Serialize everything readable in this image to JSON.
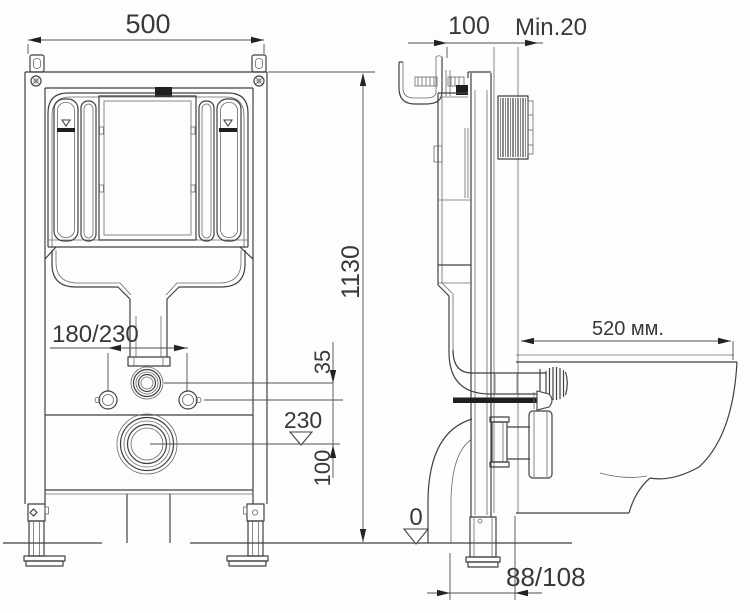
{
  "drawing": {
    "type": "installation-diagram",
    "colors": {
      "ink": "#414141",
      "dim_line": "#4f4f4f",
      "text": "#383838",
      "background": "#fdfdfd"
    },
    "labels": {
      "front": {
        "width": "500",
        "height": "1130",
        "fixing_spacing": "180/230",
        "inlet_offset": "35",
        "outlet_level": "230",
        "outlet_drop": "100"
      },
      "side": {
        "depth": "100",
        "min_wall": "Min.20",
        "bowl_length": "520 мм.",
        "floor_level": "0",
        "outlet_distance": "88/108"
      }
    }
  }
}
